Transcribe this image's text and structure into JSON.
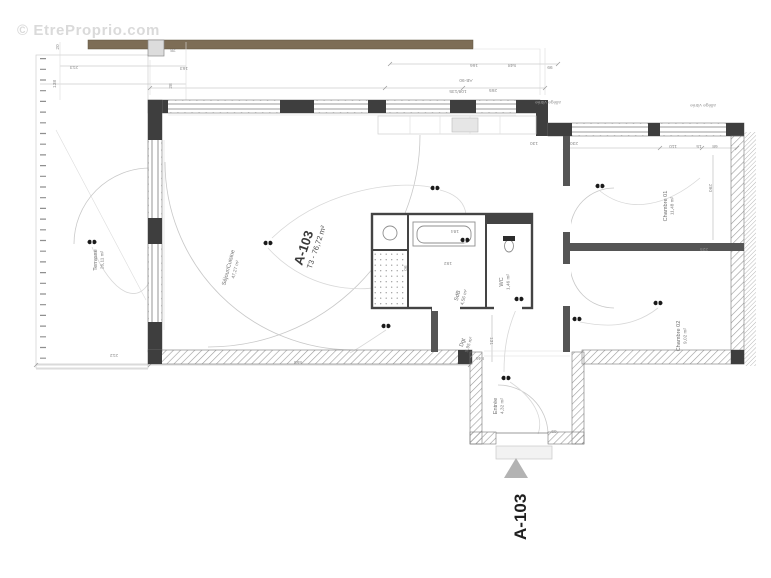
{
  "watermark": "© EtreProprio.com",
  "unit": {
    "id": "A-103",
    "spec": "T3 - 76,72 m²"
  },
  "marker": {
    "label": "A-103"
  },
  "rooms": [
    {
      "name": "Terrasse",
      "area": "26,11 m²"
    },
    {
      "name": "Séjour/Cuisine",
      "area": "47,27 m²"
    },
    {
      "name": "Chambre 01",
      "area": "11,48 m²"
    },
    {
      "name": "Chambre 02",
      "area": "9,02 m²"
    },
    {
      "name": "SdB",
      "area": "4,56 m²"
    },
    {
      "name": "WC",
      "area": "1,46 m²"
    },
    {
      "name": "Dgt",
      "area": "5,95 m²"
    },
    {
      "name": "Entrée",
      "area": "4,32 m²"
    }
  ],
  "notes": {
    "left_glazing": "allège vitrée",
    "right_glazing": "allège vitrée"
  },
  "dims": [
    "20",
    "213",
    "138",
    "28",
    "163",
    "28",
    "166",
    "548",
    "99",
    "AB-90",
    "108/135",
    "265",
    "130",
    "230",
    "110",
    "15",
    "68",
    "290",
    "192",
    "184",
    "846",
    "131",
    "69",
    "90",
    "225",
    "555",
    "212"
  ],
  "colors": {
    "wall": "#3e3e3e",
    "wood_deck": "#7d6d56",
    "arrow": "#b3b3b3",
    "watermark_text": "#dadada"
  }
}
